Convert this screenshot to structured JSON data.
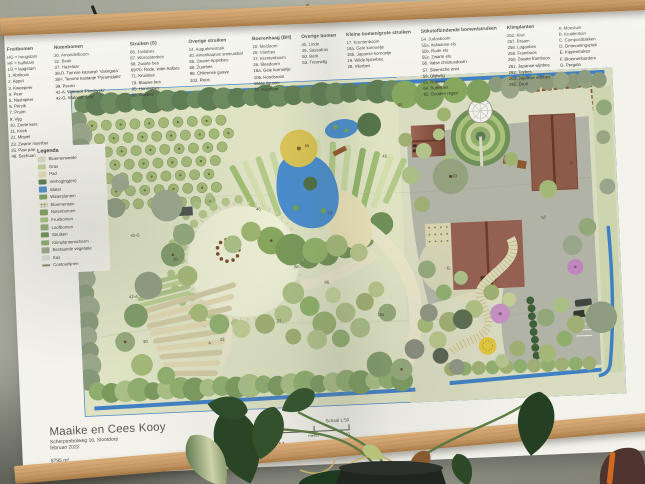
{
  "poster": {
    "title": "Maaike en Cees Kooy",
    "address": "Scherpenbolweg 16, Slootdorp",
    "date": "februari 2022",
    "area": "8795 m²",
    "nap": "-3,8 m NAP",
    "scale_label": "Schaal 1:50",
    "scale_ticks": {
      "zero": "0",
      "mid": "meter",
      "ten": "10"
    },
    "logo": {
      "word1": "BOB",
      "word2": "BORRE",
      "word3": "ACU",
      "color": "#c1272d"
    }
  },
  "plant_lists": [
    {
      "title": "Fruitbomen",
      "items": [
        "HG = hoogstam",
        "HF = halfstam",
        "LG = laagstam",
        "1. Abrikoos",
        "2. Appel",
        "3. Kweepeer",
        "4. Peer",
        "5. Nashipeer",
        "6. Perzik",
        "7. Pruim",
        "9. Vijg",
        "10. Zoete kers",
        "11. Kriek",
        "21. Mispel",
        "23. Zwarte moerbei",
        "25. Paw paw",
        "48. Sechuan peper"
      ]
    },
    {
      "title": "Notenbomen",
      "items": [
        "30. Amandelboom",
        "32. Beuk",
        "37. Hazelaar",
        "38-D. Tamme kastanje 'Variegata'",
        "38-I. Tamme kastanje 'Pyramidalis'",
        "39. Pecan",
        "42-A. Walnoot 'Plovdivski'",
        "42-G. Walnoot 'Rita'"
      ]
    },
    {
      "title": "Struiken (S)",
      "items": [
        "66. Jostabes",
        "67. Worcesterbes",
        "68. Zwarte bes",
        "69/70. Rode, witte Aalbes",
        "71. Kruisbes",
        "79. Blauwe bes",
        "95. Honingbes",
        "96. Gojibes"
      ]
    },
    {
      "title": "Overige struiken",
      "items": [
        "14. Augurkenstruik",
        "40. Amerikaanse sneeuwbal",
        "86. Zwarte Appelbes",
        "88. Zuurbes",
        "98. Chileense guave",
        "102. Roos"
      ]
    },
    {
      "title": "Boerenhaag (BH)",
      "items": [
        "20. Meidoorn",
        "28. Vlierbes",
        "17. Krentenboom",
        "26. Sleedoorn",
        "18a. Gele kornoelje",
        "106. Hondsroos",
        "Wilde liguster",
        "37. Hazelaar"
      ]
    },
    {
      "title": "Overige bomen",
      "items": [
        "45. Linde",
        "46. Sassafras",
        "50. Berk",
        "53. Treurwilg"
      ]
    },
    {
      "title": "Kleine bomen/grote struiken",
      "items": [
        "17. Krentenboom",
        "18a. Gele kornoelje",
        "18b. Japanse kornoelje",
        "19. Wilde lijsterbes",
        "28. Vlierbes"
      ]
    },
    {
      "title": "Stikstofbindende bomen/struiken",
      "items": [
        "54. Judasboom",
        "55a. Italiaanse els",
        "55b. Rode els",
        "55c. Zwarte els",
        "56. Valse christusdoorn",
        "57. Siberische erwt",
        "59. Olijfwilg",
        "63. Robinia",
        "64. Buffelbes",
        "65. Gouden regen"
      ]
    },
    {
      "title": "Klimplanten",
      "items": [
        "252. Kiwi",
        "257. Braam",
        "258. Loganbes",
        "259. Framboos",
        "260. Zwarte framboos",
        "261. Japanse wijnbes",
        "262. Taybes",
        "263. Japanse wijnbes",
        "265. Druif"
      ]
    },
    {
      "title": "",
      "items": [
        "A. Moestuin",
        "B. Kruidentuin",
        "C. Compostbakken",
        "D. Ontmoetingsplek",
        "E. Kippentraktor",
        "F. Bloemenborders",
        "G. Pergola"
      ]
    }
  ],
  "legend": {
    "title": "Legenda",
    "items": [
      {
        "label": "Bloemenweide",
        "color": "#d8dbc6",
        "style": "solid"
      },
      {
        "label": "Gras",
        "color": "#c3d097",
        "style": "solid"
      },
      {
        "label": "Pad",
        "color": "#e6dab6",
        "style": "solid"
      },
      {
        "label": "Verhoging(en)",
        "color": "#5a7a50",
        "style": "solid"
      },
      {
        "label": "Water",
        "color": "#4a8ccb",
        "style": "solid"
      },
      {
        "label": "Waterplanten",
        "color": "#79a35f",
        "style": "solid"
      },
      {
        "label": "Bloementuin",
        "color": "#eae4c8",
        "style": "dots"
      },
      {
        "label": "Notenbomen",
        "color": "#7fa05c",
        "style": "solid"
      },
      {
        "label": "Fruitbomen",
        "color": "#a9c27e",
        "style": "solid"
      },
      {
        "label": "Loofbomen",
        "color": "#93a87a",
        "style": "solid"
      },
      {
        "label": "Struiken",
        "color": "#6d8f55",
        "style": "solid"
      },
      {
        "label": "Klimplantenscherm",
        "color": "#8fae6e",
        "style": "hatch"
      },
      {
        "label": "Bestaande vegetatie",
        "color": "#9aa68c",
        "style": "solid"
      },
      {
        "label": "Kas",
        "color": "#dddfd2",
        "style": "solid"
      },
      {
        "label": "Contourlijnen",
        "color": "#8a8a70",
        "style": "line"
      }
    ]
  },
  "map_labels": [
    {
      "t": "55",
      "x": 234,
      "y": 67
    },
    {
      "t": "42-G",
      "x": 54,
      "y": 150
    },
    {
      "t": "42-A",
      "x": 50,
      "y": 212
    },
    {
      "t": "39",
      "x": 96,
      "y": 176
    },
    {
      "t": "30",
      "x": 62,
      "y": 258
    },
    {
      "t": "32",
      "x": 140,
      "y": 259
    },
    {
      "t": "23",
      "x": 198,
      "y": 243
    },
    {
      "t": "96",
      "x": 248,
      "y": 206
    },
    {
      "t": "88",
      "x": 218,
      "y": 189
    },
    {
      "t": "18a",
      "x": 300,
      "y": 241
    },
    {
      "t": "46",
      "x": 182,
      "y": 129
    },
    {
      "t": "53",
      "x": 254,
      "y": 136
    },
    {
      "t": "45",
      "x": 312,
      "y": 81
    },
    {
      "t": "63",
      "x": 382,
      "y": 104
    },
    {
      "t": "57",
      "x": 470,
      "y": 150
    },
    {
      "t": "19",
      "x": 500,
      "y": 96
    },
    {
      "t": "A",
      "x": 128,
      "y": 262
    },
    {
      "t": "F",
      "x": 420,
      "y": 212
    },
    {
      "t": "G",
      "x": 372,
      "y": 197
    },
    {
      "t": "65",
      "x": 330,
      "y": 30
    }
  ]
}
